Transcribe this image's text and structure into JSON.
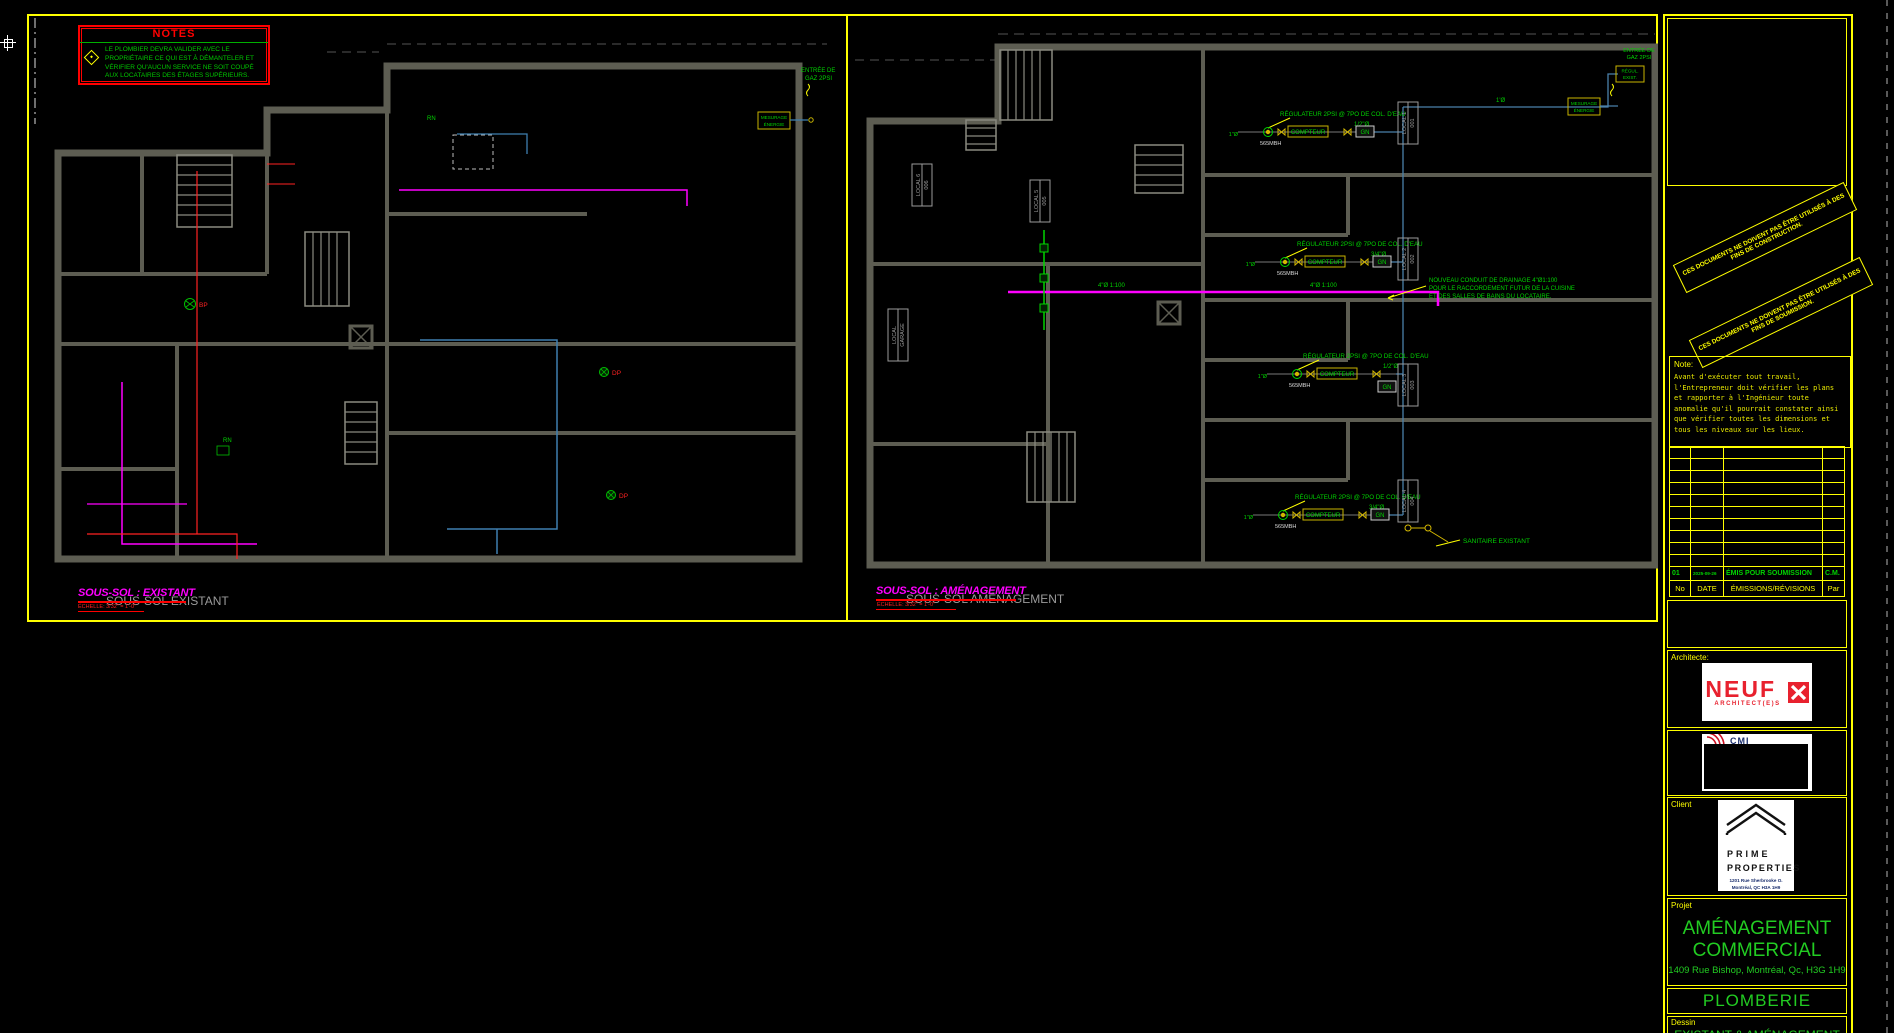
{
  "colors": {
    "border": "#ffff00",
    "green": "#00d400",
    "magenta": "#ff00ff",
    "red": "#ff0000",
    "wall": "#5d5d52",
    "pipe_blue": "#4a80aa",
    "ghost": "#9b9b9b"
  },
  "notes_box": {
    "title": "NOTES",
    "item_text": "LE PLOMBIER DEVRA VALIDER AVEC LE PROPRIÉTAIRE CE QUI EST À DÉMANTELER ET VÉRIFIER QU'AUCUN SERVICE NE SOIT COUPÉ AUX LOCATAIRES DES ÉTAGES SUPÉRIEURS."
  },
  "left_plan": {
    "title": "SOUS-SOL : EXISTANT",
    "ghost_title": "SOUS-SOL EXISTANT",
    "scale": "ÉCHELLE: 3/32\" = 1'-0\"",
    "entree_gaz_l1": "ENTRÉE DE",
    "entree_gaz_l2": "GAZ 2PSI",
    "mesurage_l1": "MESURAGE",
    "mesurage_l2": "ÉNERGIE",
    "dp": "DP",
    "bp": "BP",
    "rn": "RN"
  },
  "right_plan": {
    "title": "SOUS-SOL : AMÉNAGEMENT",
    "ghost_title": "SOUS-SOL AMÉNAGEMENT",
    "scale": "ÉCHELLE: 3/32\" = 1'-0\"",
    "regulateur": "RÉGULATEUR 2PSI @ 7PO DE COL. D'EAU",
    "compteur": "COMPTEUR",
    "gn": "GN",
    "mbh": "565MBH",
    "dia_1": "1\"Ø",
    "dia_half": "1/2\"Ø",
    "dia_34": "3/4\"Ø",
    "dia_main": "1'Ø",
    "drain_dia": "4\"Ø 1:100",
    "drain_note_l1": "NOUVEAU CONDUIT DE DRAINAGE 4\"Ø1:100",
    "drain_note_l2": "POUR LE RACCORDEMENT FUTUR DE LA CUISINE",
    "drain_note_l3": "ET DES SALLES DE BAINS DU LOCATAIRE.",
    "sanitaire": "SANITAIRE EXISTANT",
    "entree_gaz_l1": "ENTRÉE DE",
    "entree_gaz_l2": "GAZ 2PSI",
    "mesurage_l1": "MESURAGE",
    "mesurage_l2": "ÉNERGIE",
    "regul_exist_l1": "RÉGUL.",
    "regul_exist_l2": "EXIST.",
    "locals": [
      {
        "name": "LOCAL 1",
        "num": "001"
      },
      {
        "name": "LOCAL 2",
        "num": "002"
      },
      {
        "name": "LOCAL 3",
        "num": "003"
      },
      {
        "name": "LOCAL 4",
        "num": "004"
      },
      {
        "name": "LOCAL 5",
        "num": "005"
      },
      {
        "name": "LOCAL 6",
        "num": "006"
      }
    ],
    "local_garage_l1": "LOCAL",
    "local_garage_l2": "GARAGE"
  },
  "titleblock": {
    "stamp1": "CES DOCUMENTS NE DOIVENT PAS ÊTRE UTILISÉS À DES FINS DE CONSTRUCTION.",
    "stamp2": "CES DOCUMENTS NE DOIVENT PAS ÊTRE UTILISÉS À DES FINS DE SOUMISSION.",
    "note_label": "Note:",
    "note_text": "Avant d'exécuter tout travail, l'Entrepreneur doit vérifier les plans et rapporter à l'Ingénieur toute anomalie qu'il pourrait constater ainsi que vérifier toutes les dimensions et tous les niveaux sur les lieux.",
    "revision": {
      "no": "01",
      "date": "2025-09-26",
      "desc": "ÉMIS POUR SOUMISSION",
      "par": "C.M."
    },
    "rev_headers": {
      "no": "No",
      "date": "DATE",
      "desc": "ÉMISSIONS/RÉVISIONS",
      "par": "Par"
    },
    "architecte_label": "Architecte:",
    "architect_logo": {
      "name": "NEUF",
      "sub": "ARCHITECT(E)S"
    },
    "engineer_logo": {
      "text": "CMI"
    },
    "client_label": "Client",
    "client_logo": {
      "line1": "PRIME",
      "line2": "PROPERTIES",
      "addr1": "1201 Rue Sherbrooke O.",
      "addr2": "Montréal, QC H3A 1H9"
    },
    "projet_label": "Projet",
    "project_title_l1": "AMÉNAGEMENT",
    "project_title_l2": "COMMERCIAL",
    "project_addr": "1409 Rue Bishop, Montréal, Qc, H3G 1H9",
    "discipline": "PLOMBERIE",
    "dessin_label": "Dessin",
    "dessin_title": "EXISTANT & AMÉNAGEMENT"
  }
}
